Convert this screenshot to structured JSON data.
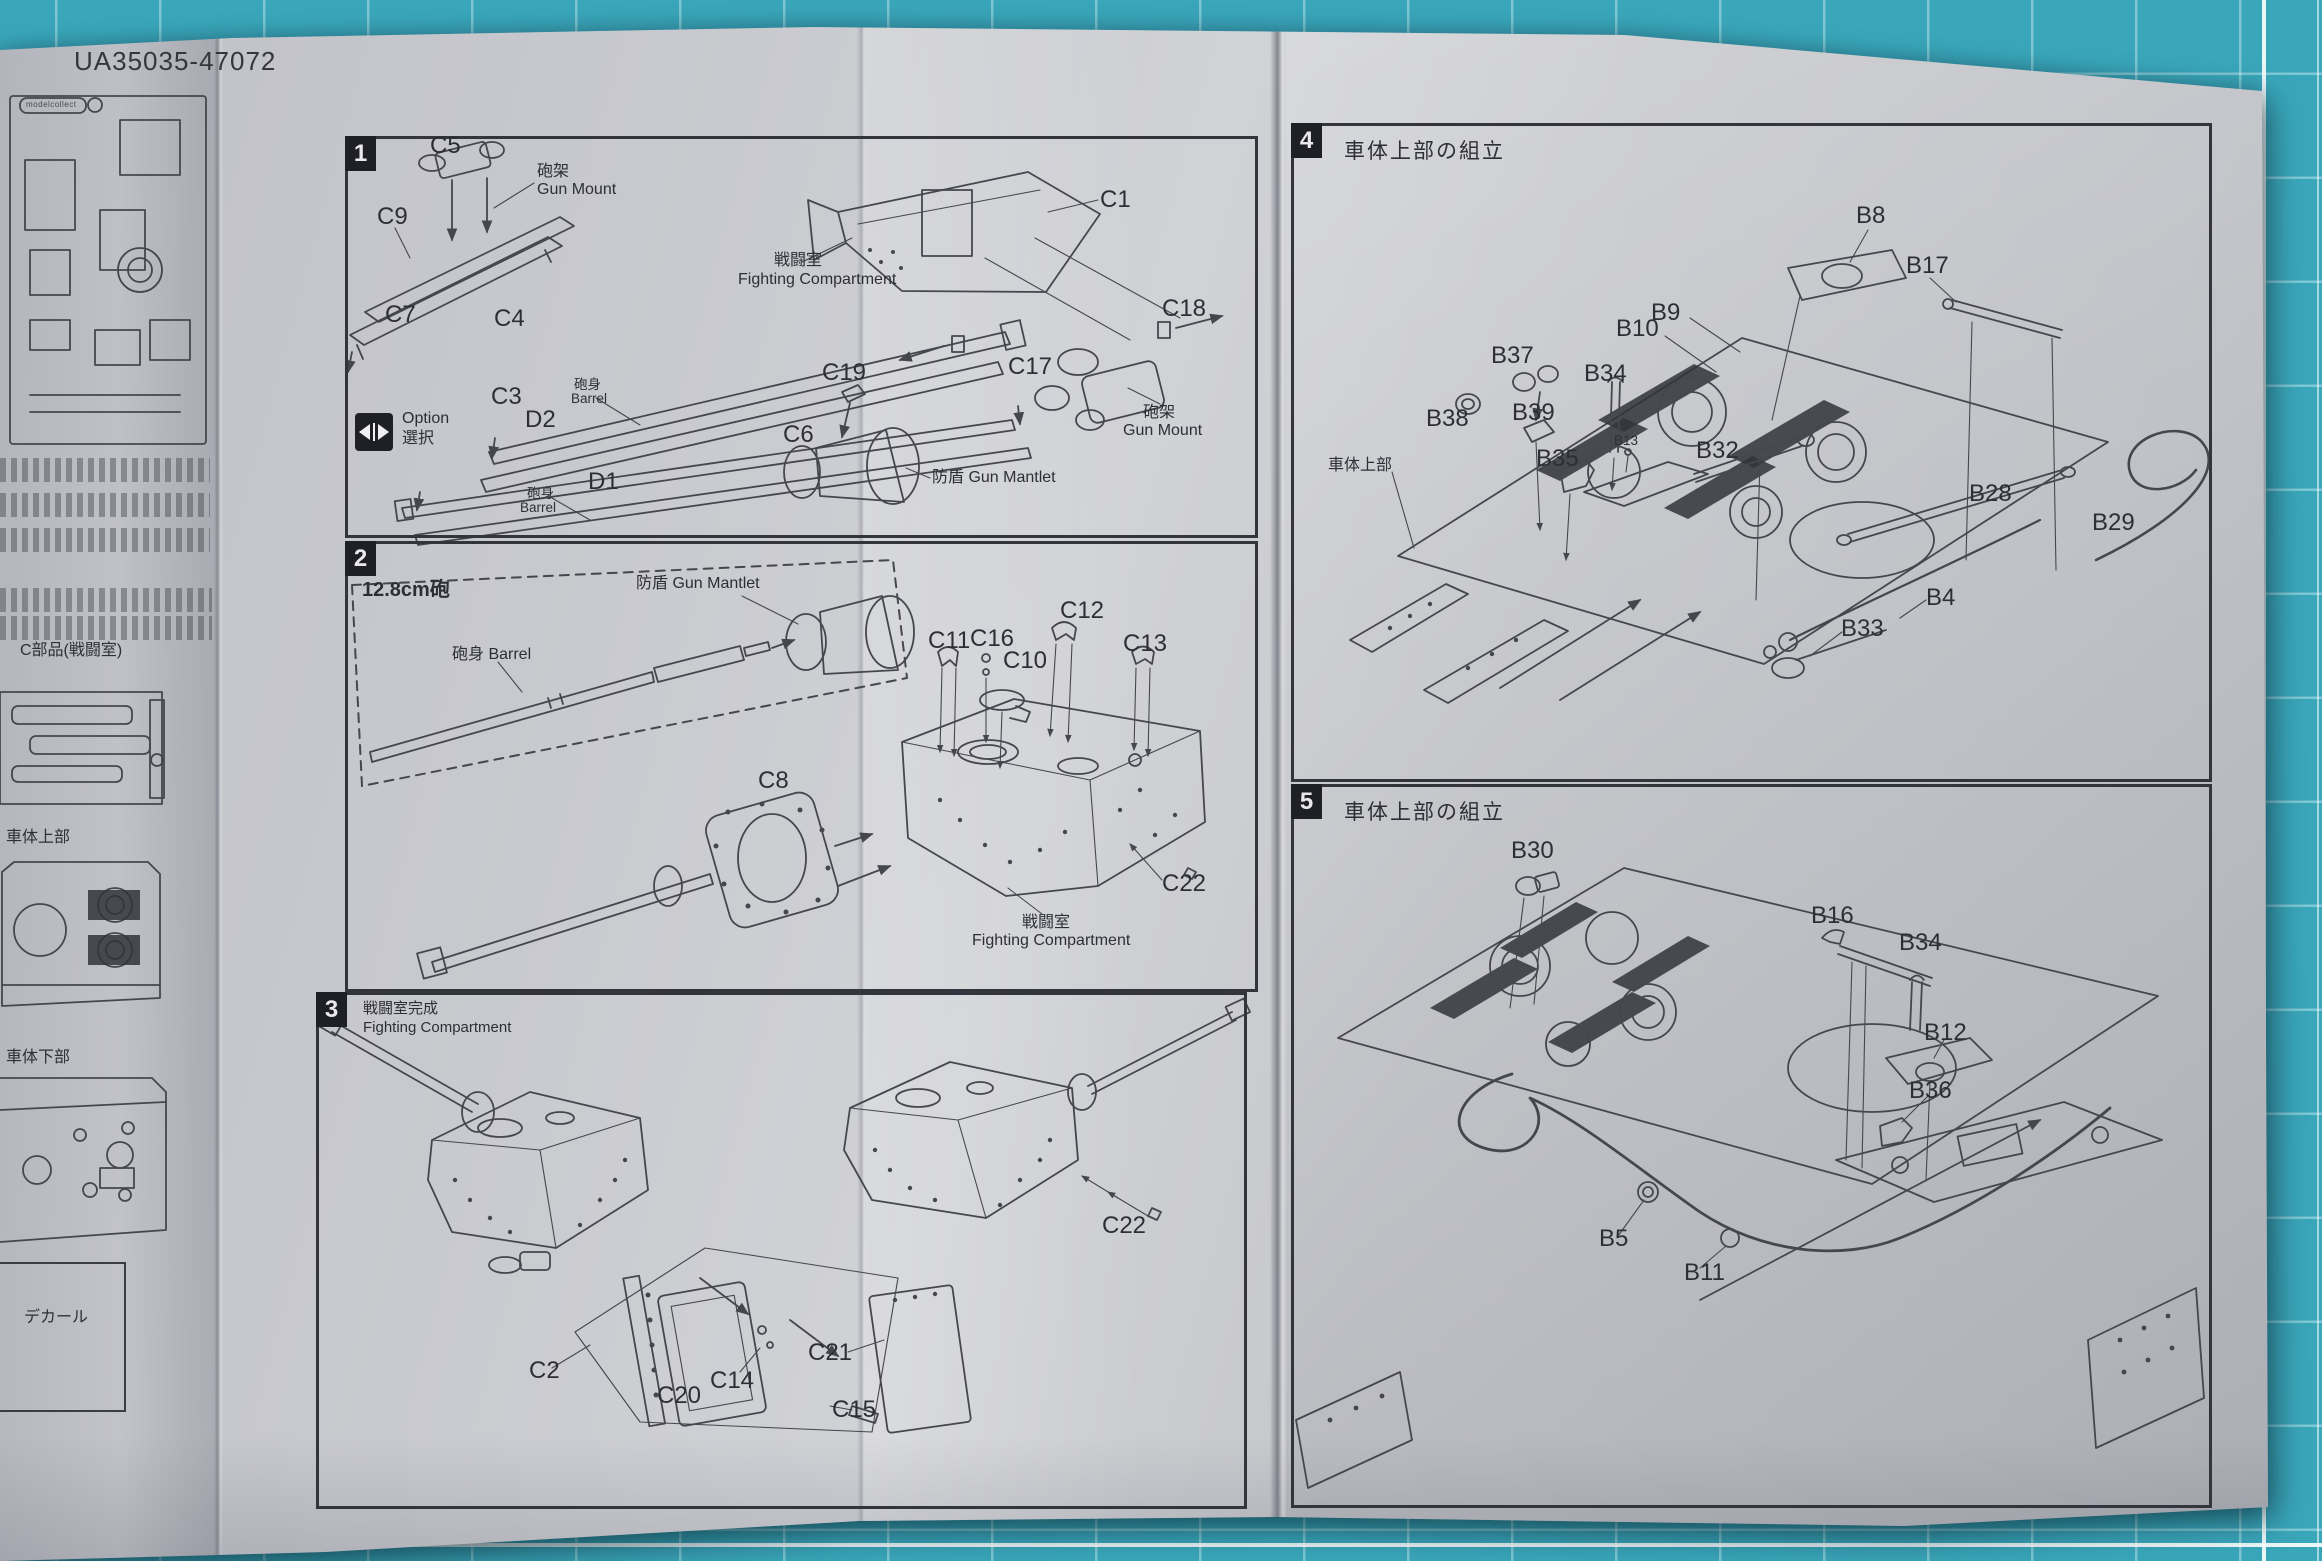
{
  "page": {
    "kit_code": "UA35035-47072",
    "brand": "modelcollect",
    "paper_color": "#c8c9cd",
    "mat_color": "#3aa6ba",
    "ink_color": "#46474e"
  },
  "left_column": {
    "labels": [
      {
        "text": "C部品(戦闘室)",
        "x": 20,
        "y": 643,
        "cls": "anno"
      },
      {
        "text": "車体上部",
        "x": 6,
        "y": 830,
        "cls": "anno"
      },
      {
        "text": "車体下部",
        "x": 6,
        "y": 1050,
        "cls": "anno"
      },
      {
        "text": "デカール",
        "x": 24,
        "y": 1310,
        "cls": "anno"
      }
    ]
  },
  "steps": [
    {
      "number": "1",
      "labels": [
        {
          "text": "C5",
          "x": 430,
          "y": 133,
          "cls": "code"
        },
        {
          "text": "砲架",
          "x": 537,
          "y": 164,
          "cls": "anno"
        },
        {
          "text": "Gun Mount",
          "x": 537,
          "y": 182,
          "cls": "anno"
        },
        {
          "text": "C9",
          "x": 377,
          "y": 204,
          "cls": "code"
        },
        {
          "text": "C7",
          "x": 385,
          "y": 302,
          "cls": "code"
        },
        {
          "text": "C4",
          "x": 494,
          "y": 306,
          "cls": "code"
        },
        {
          "text": "C3",
          "x": 491,
          "y": 384,
          "cls": "code"
        },
        {
          "text": "砲身",
          "x": 574,
          "y": 378,
          "cls": "small"
        },
        {
          "text": "Barrel",
          "x": 571,
          "y": 392,
          "cls": "small"
        },
        {
          "text": "Option",
          "x": 402,
          "y": 411,
          "cls": "anno"
        },
        {
          "text": "選択",
          "x": 402,
          "y": 431,
          "cls": "anno"
        },
        {
          "text": "D2",
          "x": 525,
          "y": 407,
          "cls": "code"
        },
        {
          "text": "D1",
          "x": 588,
          "y": 469,
          "cls": "code"
        },
        {
          "text": "砲身",
          "x": 527,
          "y": 487,
          "cls": "small"
        },
        {
          "text": "Barrel",
          "x": 520,
          "y": 501,
          "cls": "small"
        },
        {
          "text": "C1",
          "x": 1100,
          "y": 187,
          "cls": "code"
        },
        {
          "text": "戦闘室",
          "x": 774,
          "y": 253,
          "cls": "anno"
        },
        {
          "text": "Fighting Compartment",
          "x": 738,
          "y": 272,
          "cls": "anno"
        },
        {
          "text": "C18",
          "x": 1162,
          "y": 296,
          "cls": "code"
        },
        {
          "text": "C17",
          "x": 1008,
          "y": 354,
          "cls": "code"
        },
        {
          "text": "C19",
          "x": 822,
          "y": 360,
          "cls": "code"
        },
        {
          "text": "C6",
          "x": 783,
          "y": 422,
          "cls": "code"
        },
        {
          "text": "砲架",
          "x": 1143,
          "y": 405,
          "cls": "anno"
        },
        {
          "text": "Gun Mount",
          "x": 1123,
          "y": 423,
          "cls": "anno"
        },
        {
          "text": "防盾 Gun Mantlet",
          "x": 932,
          "y": 470,
          "cls": "anno"
        }
      ]
    },
    {
      "number": "2",
      "labels": [
        {
          "text": "12.8cm砲",
          "x": 362,
          "y": 580,
          "cls": "sub"
        },
        {
          "text": "防盾 Gun Mantlet",
          "x": 636,
          "y": 576,
          "cls": "anno"
        },
        {
          "text": "砲身 Barrel",
          "x": 452,
          "y": 647,
          "cls": "anno"
        },
        {
          "text": "C11",
          "x": 928,
          "y": 628,
          "cls": "code"
        },
        {
          "text": "C16",
          "x": 970,
          "y": 626,
          "cls": "code"
        },
        {
          "text": "C10",
          "x": 1003,
          "y": 648,
          "cls": "code"
        },
        {
          "text": "C12",
          "x": 1060,
          "y": 598,
          "cls": "code"
        },
        {
          "text": "C13",
          "x": 1123,
          "y": 631,
          "cls": "code"
        },
        {
          "text": "C8",
          "x": 758,
          "y": 768,
          "cls": "code"
        },
        {
          "text": "C22",
          "x": 1162,
          "y": 871,
          "cls": "code"
        },
        {
          "text": "戦闘室",
          "x": 1022,
          "y": 915,
          "cls": "anno"
        },
        {
          "text": "Fighting Compartment",
          "x": 972,
          "y": 933,
          "cls": "anno"
        }
      ]
    },
    {
      "number": "3",
      "title_jp": "戦闘室完成",
      "title_en": "Fighting Compartment",
      "labels": [
        {
          "text": "C2",
          "x": 529,
          "y": 1358,
          "cls": "code"
        },
        {
          "text": "C20",
          "x": 657,
          "y": 1383,
          "cls": "code"
        },
        {
          "text": "C14",
          "x": 710,
          "y": 1368,
          "cls": "code"
        },
        {
          "text": "C21",
          "x": 808,
          "y": 1340,
          "cls": "code"
        },
        {
          "text": "C15",
          "x": 832,
          "y": 1397,
          "cls": "code"
        },
        {
          "text": "C22",
          "x": 1102,
          "y": 1213,
          "cls": "code"
        }
      ]
    },
    {
      "number": "4",
      "title": "車体上部の組立",
      "labels": [
        {
          "text": "B8",
          "x": 1856,
          "y": 203,
          "cls": "code"
        },
        {
          "text": "B17",
          "x": 1906,
          "y": 253,
          "cls": "code"
        },
        {
          "text": "B9",
          "x": 1651,
          "y": 300,
          "cls": "code"
        },
        {
          "text": "B10",
          "x": 1616,
          "y": 316,
          "cls": "code"
        },
        {
          "text": "B37",
          "x": 1491,
          "y": 343,
          "cls": "code"
        },
        {
          "text": "B34",
          "x": 1584,
          "y": 361,
          "cls": "code"
        },
        {
          "text": "B38",
          "x": 1426,
          "y": 406,
          "cls": "code"
        },
        {
          "text": "B39",
          "x": 1512,
          "y": 400,
          "cls": "code"
        },
        {
          "text": "B13",
          "x": 1614,
          "y": 434,
          "cls": "small"
        },
        {
          "text": "B32",
          "x": 1696,
          "y": 438,
          "cls": "code"
        },
        {
          "text": "B35",
          "x": 1536,
          "y": 446,
          "cls": "code"
        },
        {
          "text": "車体上部",
          "x": 1328,
          "y": 458,
          "cls": "anno"
        },
        {
          "text": "B28",
          "x": 1969,
          "y": 481,
          "cls": "code"
        },
        {
          "text": "B29",
          "x": 2092,
          "y": 510,
          "cls": "code"
        },
        {
          "text": "B4",
          "x": 1926,
          "y": 585,
          "cls": "code"
        },
        {
          "text": "B33",
          "x": 1841,
          "y": 616,
          "cls": "code"
        }
      ]
    },
    {
      "number": "5",
      "title": "車体上部の組立",
      "labels": [
        {
          "text": "B30",
          "x": 1511,
          "y": 838,
          "cls": "code"
        },
        {
          "text": "B16",
          "x": 1811,
          "y": 903,
          "cls": "code"
        },
        {
          "text": "B34",
          "x": 1899,
          "y": 930,
          "cls": "code"
        },
        {
          "text": "B12",
          "x": 1924,
          "y": 1020,
          "cls": "code"
        },
        {
          "text": "B36",
          "x": 1909,
          "y": 1078,
          "cls": "code"
        },
        {
          "text": "B5",
          "x": 1599,
          "y": 1226,
          "cls": "code"
        },
        {
          "text": "B11",
          "x": 1684,
          "y": 1260,
          "cls": "code"
        }
      ]
    }
  ]
}
